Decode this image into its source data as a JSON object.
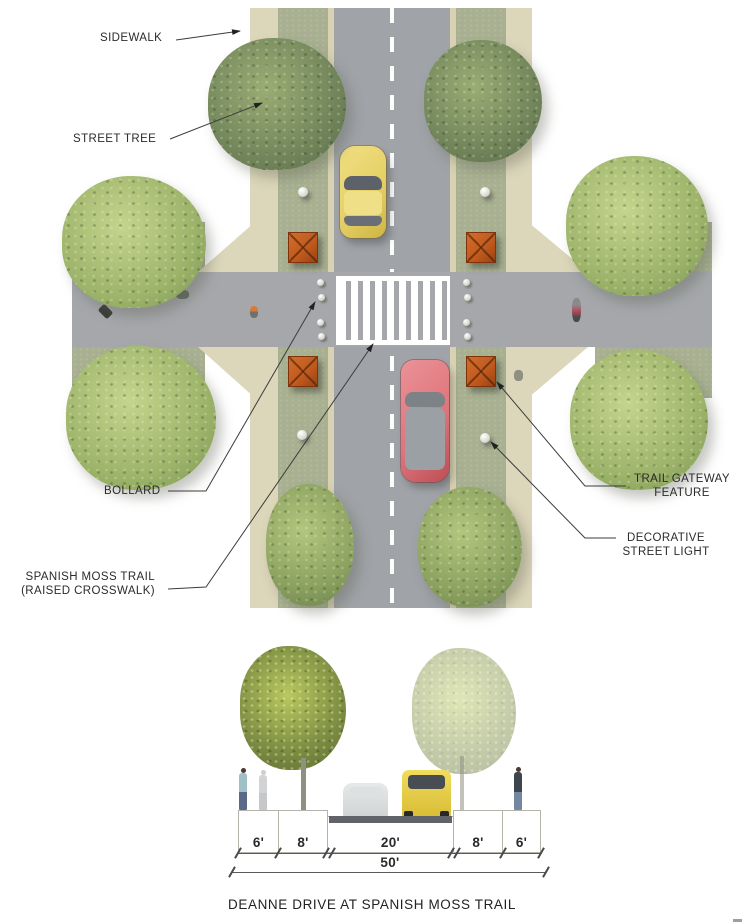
{
  "plan": {
    "labels": {
      "sidewalk": "SIDEWALK",
      "street_tree": "STREET TREE",
      "bollard": "BOLLARD",
      "spanish_moss_line1": "SPANISH MOSS TRAIL",
      "spanish_moss_line2": "(RAISED CROSSWALK)",
      "gateway_line1": "TRAIL GATEWAY",
      "gateway_line2": "FEATURE",
      "light_line1": "DECORATIVE",
      "light_line2": "STREET LIGHT"
    }
  },
  "section": {
    "dimensions": [
      "6'",
      "8'",
      "20'",
      "8'",
      "6'"
    ],
    "total_width": "50'",
    "caption": "DEANNE DRIVE AT SPANISH MOSS TRAIL"
  },
  "colors": {
    "sidewalk": "#dcd6ba",
    "planting": "#a8b091",
    "curb": "#d8d2b2",
    "road": "#a0a3a7",
    "trail": "#a5a7aa",
    "gateway": "#c25b1e",
    "car_yellow": "#e6d066",
    "car_red": "#de767c",
    "label_text": "#2b2b2b"
  }
}
